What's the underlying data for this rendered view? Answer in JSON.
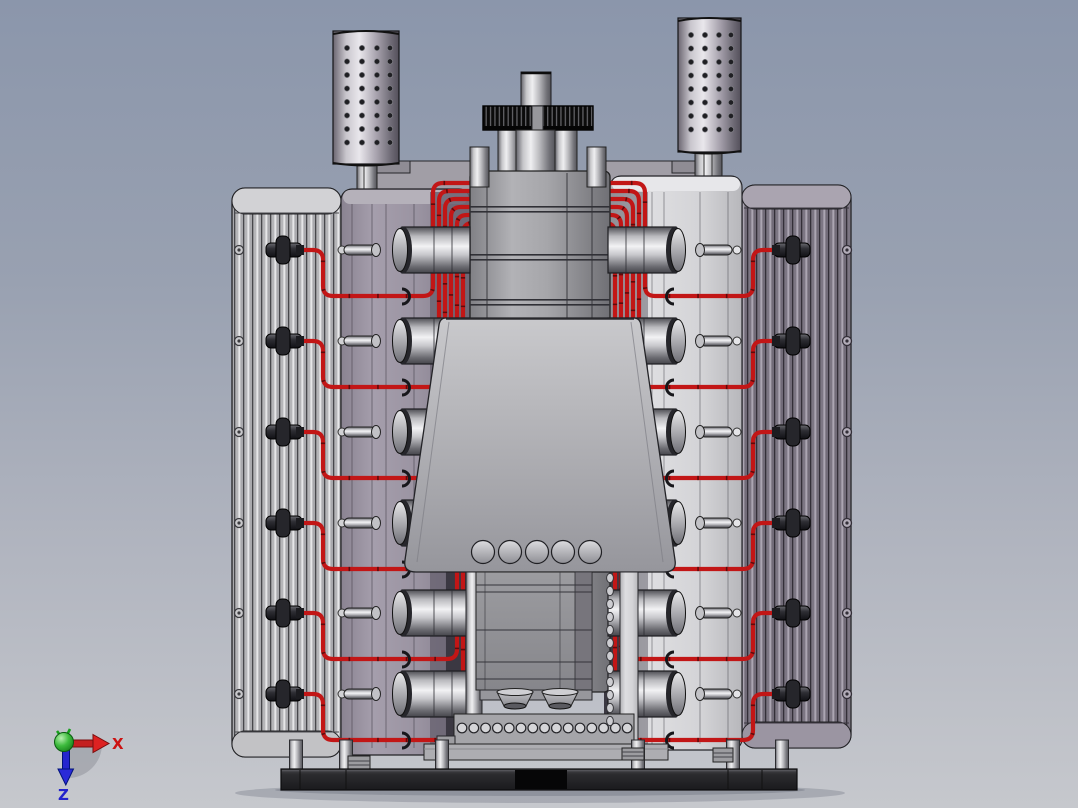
{
  "viewport": {
    "description": "Shaded 3D CAD render of a twin-bank V12-style engine assembly with finned cylinder blocks, perforated mufflers, top gear drive, red ignition wiring and a mounting base plate, front orthographic view",
    "axis_triad": {
      "x_label": "X",
      "z_label": "Z"
    },
    "colors": {
      "background_top": "#8b96ab",
      "background_bottom": "#c6c8cd",
      "ignition_wire": "#c21616",
      "ignition_wire_dark": "#5f0a0a",
      "gear": "#0b0b0b",
      "base_plate": "#2c2c2f",
      "axis_x": "#cc1111",
      "axis_z": "#1f1fd0",
      "axis_origin": "#2fae2f",
      "left_bank": "#9a93a1",
      "right_bank": "#d6d6d9",
      "left_fins": "#c7c7ca",
      "right_fins": "#8f8a96"
    },
    "model": {
      "cylinder_rows": 6,
      "row_centers_y": [
        250,
        341,
        432,
        523,
        613,
        694
      ],
      "spark_plugs_per_bank": 6,
      "muffler_holes": {
        "columns": 4,
        "rows": 8
      },
      "front_cover_bump_count": 5,
      "front_cover_bump_xs": [
        483,
        510,
        537,
        563,
        590
      ],
      "base_hole_count": 15,
      "leg_xs": [
        296,
        346,
        442,
        638,
        733,
        782
      ],
      "ring_chain_count": 12
    }
  }
}
